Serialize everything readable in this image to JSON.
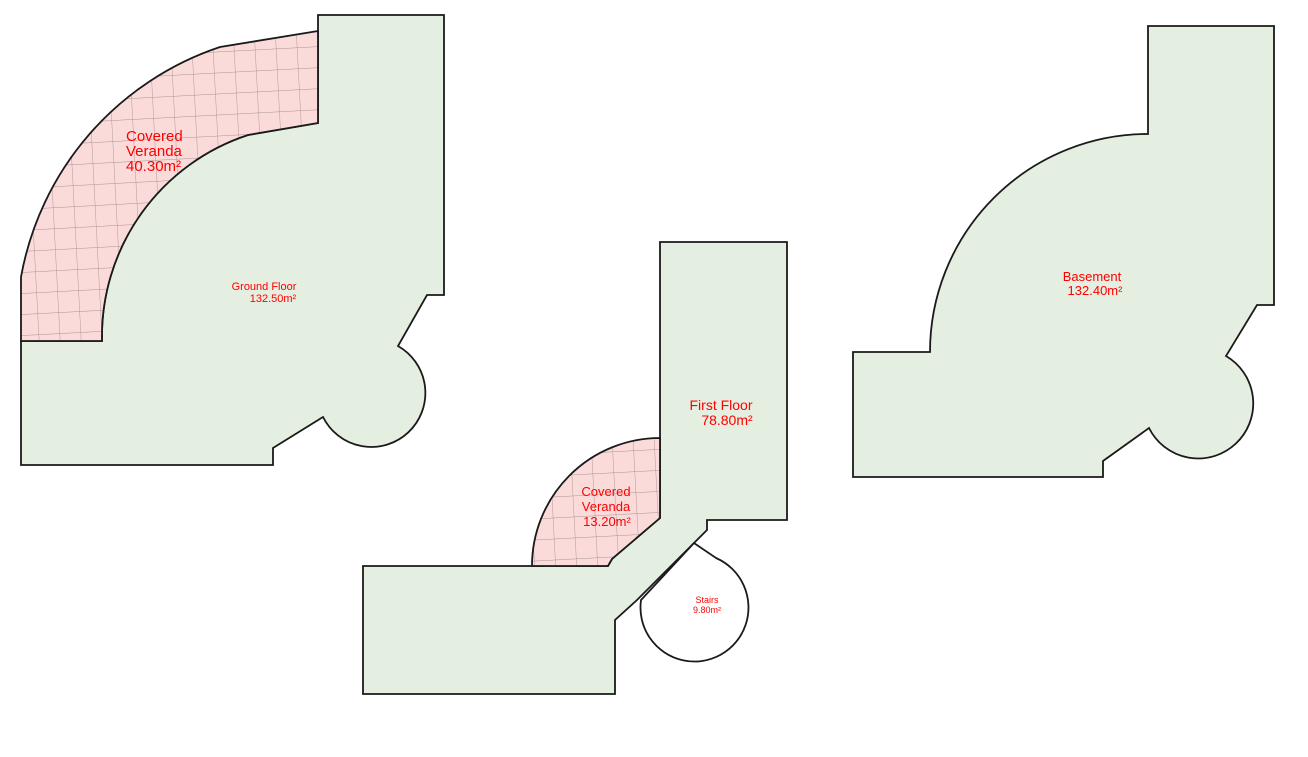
{
  "colors": {
    "floor_fill": "#e5efe1",
    "veranda_fill": "#fbdada",
    "veranda_grid": "#a89494",
    "outline": "#1a1a1a",
    "label": "#ff0000",
    "stairs_fill": "#ffffff",
    "background": "#ffffff"
  },
  "plans": {
    "ground_floor": {
      "name": "Ground Floor",
      "area": "132.50m²",
      "veranda": {
        "line1": "Covered",
        "line2": "Veranda",
        "area": "40.30m²"
      }
    },
    "first_floor": {
      "name": "First Floor",
      "area": "78.80m²",
      "veranda": {
        "line1": "Covered",
        "line2": "Veranda",
        "area": "13.20m²"
      },
      "stairs": {
        "name": "Stairs",
        "area": "9.80m²"
      }
    },
    "basement": {
      "name": "Basement",
      "area": "132.40m²"
    }
  }
}
